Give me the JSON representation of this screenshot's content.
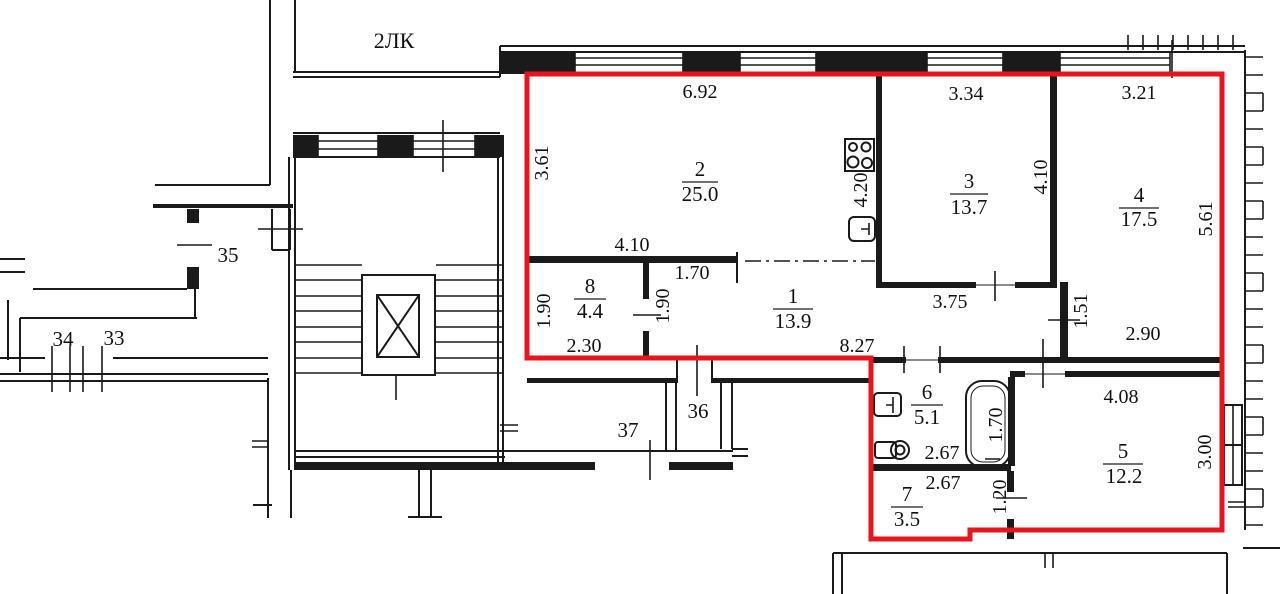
{
  "plan": {
    "building_label": "2ЛК",
    "highlight_color": "#e9151c",
    "line_color": "#1a1a1a",
    "apartment": {
      "rooms": [
        {
          "number": "1",
          "area": "13.9"
        },
        {
          "number": "2",
          "area": "25.0"
        },
        {
          "number": "3",
          "area": "13.7"
        },
        {
          "number": "4",
          "area": "17.5"
        },
        {
          "number": "5",
          "area": "12.2"
        },
        {
          "number": "6",
          "area": "5.1"
        },
        {
          "number": "7",
          "area": "3.5"
        },
        {
          "number": "8",
          "area": "4.4"
        }
      ],
      "dimensions": {
        "room2_width": "6.92",
        "room3_width": "3.34",
        "room4_width": "3.21",
        "room2_depth": "3.61",
        "kitchen_zone": "4.20",
        "room3_depth": "4.10",
        "room4_depth": "5.61",
        "room8_width_top": "4.10",
        "hall_niche": "1.70",
        "room8_depth": "1.90",
        "room8_door": "1.90",
        "room8_width_bottom": "2.30",
        "hall_length": "8.27",
        "room3_bottom": "3.75",
        "hall_jog": "1.51",
        "room4_bottom_width": "2.90",
        "room5_width": "4.08",
        "room5_depth": "3.00",
        "room6_width": "2.67",
        "room7_width": "2.67",
        "bath_length": "1.70",
        "room7_door": "1.20"
      }
    },
    "common_areas": {
      "room35": "35",
      "room34": "34",
      "room33": "33",
      "room36": "36",
      "room37": "37"
    }
  }
}
